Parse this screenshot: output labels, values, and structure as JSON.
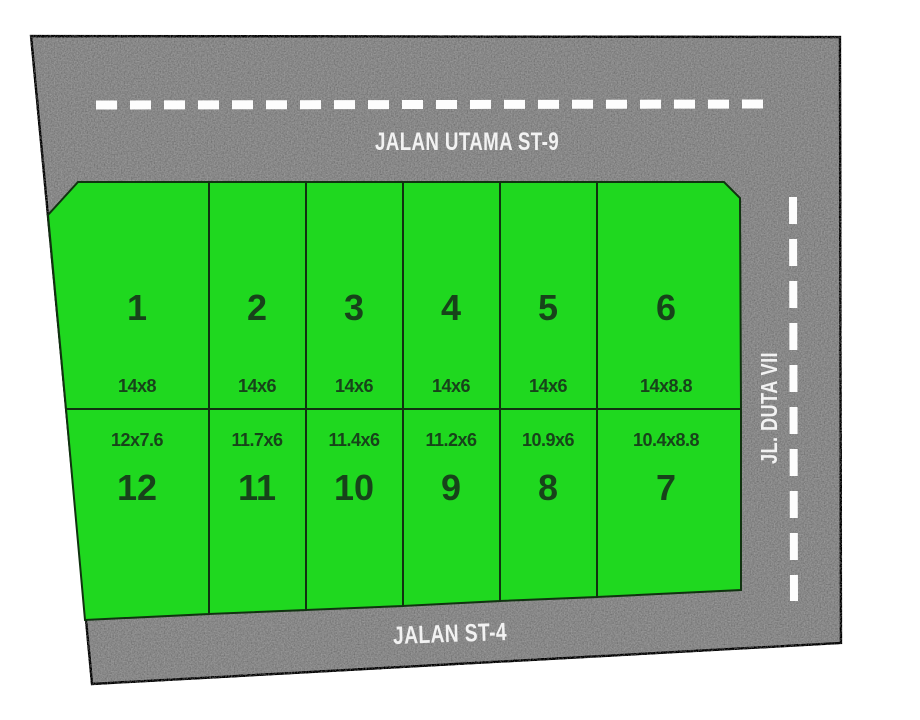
{
  "site_plan": {
    "roads": {
      "top_label": "JALAN UTAMA ST-9",
      "bottom_label": "JALAN ST-4",
      "right_label": "JL. DUTA VII"
    },
    "plots": [
      {
        "number": "1",
        "size": "14x8"
      },
      {
        "number": "2",
        "size": "14x6"
      },
      {
        "number": "3",
        "size": "14x6"
      },
      {
        "number": "4",
        "size": "14x6"
      },
      {
        "number": "5",
        "size": "14x6"
      },
      {
        "number": "6",
        "size": "14x8.8"
      },
      {
        "number": "7",
        "size": "10.4x8.8"
      },
      {
        "number": "8",
        "size": "10.9x6"
      },
      {
        "number": "9",
        "size": "11.2x6"
      },
      {
        "number": "10",
        "size": "11.4x6"
      },
      {
        "number": "11",
        "size": "11.7x6"
      },
      {
        "number": "12",
        "size": "12x7.6"
      }
    ],
    "colors": {
      "plot_green": "#1fd81f",
      "road_gray": "#888888",
      "marking_white": "#fdfdfd",
      "plot_text": "#17431a",
      "outline_black": "#151515"
    }
  }
}
